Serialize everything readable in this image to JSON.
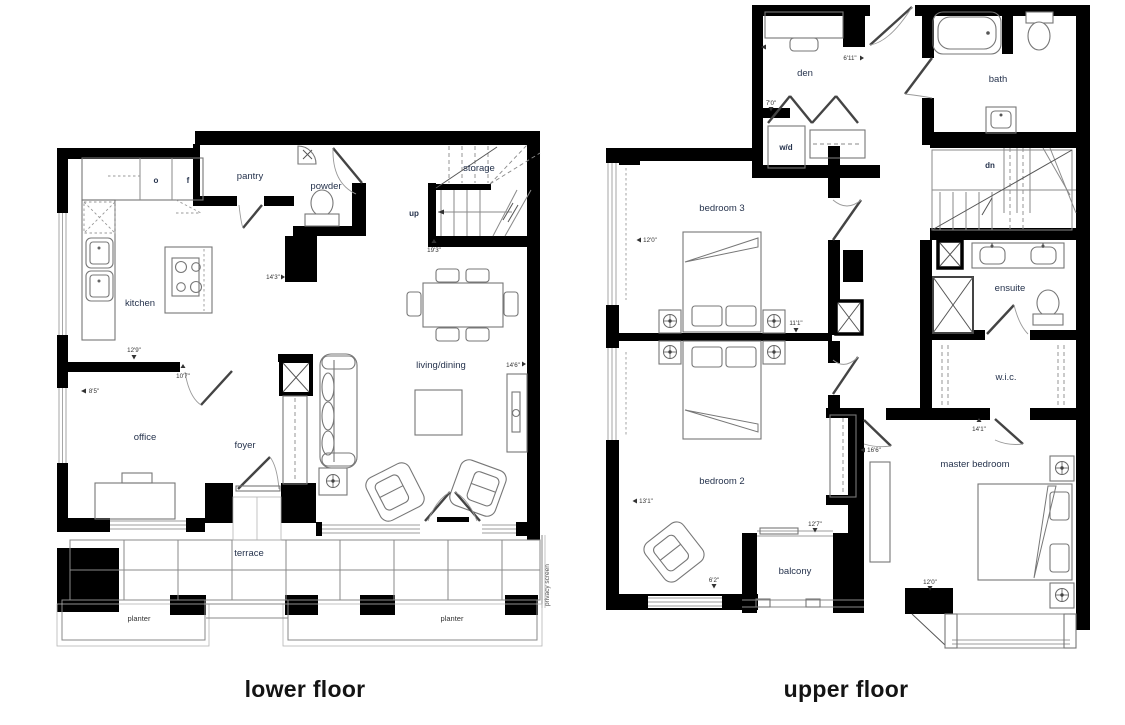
{
  "titles": {
    "lower": "lower floor",
    "upper": "upper floor"
  },
  "lower": {
    "rooms": {
      "kitchen": "kitchen",
      "pantry": "pantry",
      "powder": "powder",
      "storage": "storage",
      "stairs_up": "up",
      "living_dining": "living/dining",
      "office": "office",
      "foyer": "foyer",
      "terrace": "terrace",
      "planter_left": "planter",
      "planter_right": "planter"
    },
    "appliances": {
      "oven": "o",
      "fridge": "f"
    },
    "annotations": {
      "privacy_screen": "privacy screen"
    },
    "dimensions": {
      "kitchen_width": "12'9\"",
      "kitchen_depth": "14'3\"",
      "office_width": "10'7\"",
      "office_depth": "8'5\"",
      "stair_run": "19'3\"",
      "living_width": "14'6\""
    }
  },
  "upper": {
    "rooms": {
      "den": "den",
      "bath": "bath",
      "laundry": "w/d",
      "stairs_down": "dn",
      "bedroom3": "bedroom 3",
      "ensuite": "ensuite",
      "wic": "w.i.c.",
      "bedroom2": "bedroom 2",
      "balcony": "balcony",
      "master_bedroom": "master bedroom"
    },
    "dimensions": {
      "den_width": "6'11\"",
      "den_depth": "7'0\"",
      "bedroom3_width": "12'0\"",
      "bedroom3_depth": "11'1\"",
      "bedroom2_width": "13'1\"",
      "closet_width": "16'6\"",
      "wic_width": "14'1\"",
      "balcony_width": "12'7\"",
      "balcony_depth": "6'2\"",
      "master_width": "12'0\""
    }
  },
  "colors": {
    "wall": "#000000",
    "room_label": "#26334d",
    "dimension": "#323232"
  }
}
